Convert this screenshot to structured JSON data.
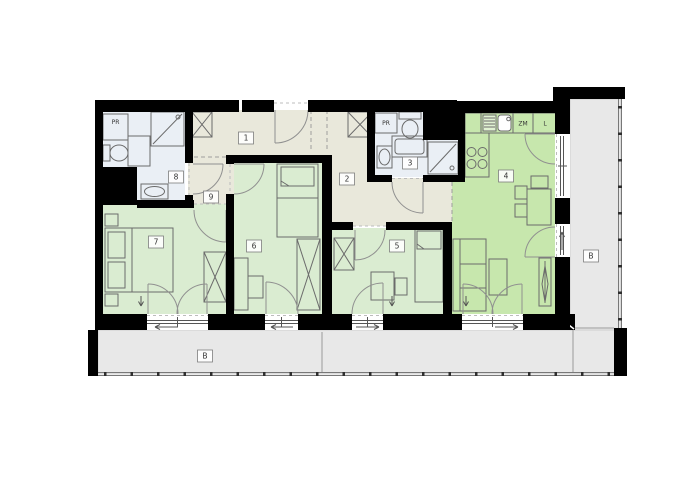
{
  "plan": {
    "type": "apartment-floor-plan",
    "colors": {
      "wall": "#000000",
      "hallway_floor": "#e9e8db",
      "bathroom_floor": "#eaeff5",
      "bedroom_floor": "#daecd1",
      "living_floor": "#c7e7ad",
      "balcony_floor": "#e8e8e8"
    },
    "rooms": [
      {
        "id": "room-1",
        "label": "1",
        "type": "entrance-hall"
      },
      {
        "id": "room-2",
        "label": "2",
        "type": "corridor"
      },
      {
        "id": "room-3",
        "label": "3",
        "type": "bathroom"
      },
      {
        "id": "room-4",
        "label": "4",
        "type": "living-room-with-kitchen"
      },
      {
        "id": "room-5",
        "label": "5",
        "type": "bedroom"
      },
      {
        "id": "room-6",
        "label": "6",
        "type": "bedroom"
      },
      {
        "id": "room-7",
        "label": "7",
        "type": "bedroom"
      },
      {
        "id": "room-8",
        "label": "8",
        "type": "bathroom"
      },
      {
        "id": "room-9",
        "label": "9",
        "type": "inner-hall"
      }
    ],
    "balconies": [
      {
        "id": "balcony-right",
        "label": "B"
      },
      {
        "id": "balcony-bottom",
        "label": "B"
      }
    ],
    "fixtures": {
      "washer_bath8": "PR",
      "washer_bath3": "PR",
      "dishwasher": "ZM",
      "fridge": "L"
    }
  }
}
